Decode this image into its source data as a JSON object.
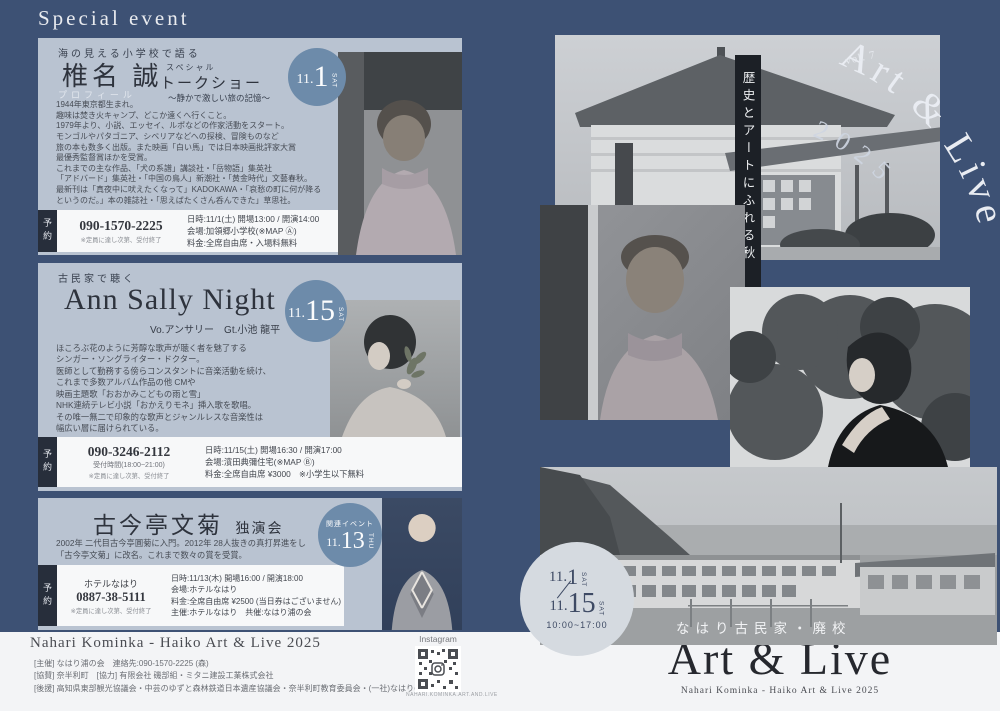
{
  "colors": {
    "background_navy": "#3d5174",
    "card_bg": "#b9c3d1",
    "date_circle_blue": "#6d8baa",
    "reserve_tab_dark": "#272e3b",
    "footer_bg": "#f3f4f6",
    "ribbon_black": "#1c2026"
  },
  "page": {
    "header_title": "Special event"
  },
  "events": [
    {
      "tagline": "海の見える小学校で語る",
      "title": "椎名 誠",
      "subtitle_small": "スペシャル",
      "subtitle": "トークショー",
      "subcaption": "〜静かで激しい旅の記憶〜",
      "badge": {
        "month": "11.",
        "day": "1",
        "dow": "SAT"
      },
      "profile_label": "プロフィール",
      "description": "1944年東京都生まれ。\n趣味は焚き火キャンプ、どこか遠くへ行くこと。\n1979年より、小説、エッセイ、ルポなどの作家活動をスタート。\nモンゴルやパタゴニア、シベリアなどへの探検、冒険ものなど\n旅の本も数多く出版。また映画「白い馬」では日本映画批評家大賞\n最優秀監督賞ほかを受賞。\nこれまでの主な作品、「犬の系譜」講談社・「岳物語」集英社\n「アドバード」集英社・「中国の鳥人」新潮社・「黄金時代」文藝春秋。\n最新刊は「真夜中に吠えたくなって」KADOKAWA・「哀愁の町に何が降る\nというのだ。」本の雑誌社・「思えばたくさん呑んできた」草思社。",
      "reserve_label": "予約",
      "phone": "090-1570-2225",
      "phone_note": "※定員に達し次第、受付終了",
      "details": "日時:11/1(土) 開場13:00 / 開演14:00\n会場:加領郷小学校(※MAP Ⓐ)\n料金:全席自由席・入場料無料"
    },
    {
      "tagline": "古民家で聴く",
      "title": "Ann Sally Night",
      "performers": "Vo.アンサリー　Gt.小池 龍平",
      "badge": {
        "month": "11.",
        "day": "15",
        "dow": "SAT"
      },
      "description": "ほころぶ花のように芳醇な歌声が聴く者を魅了する\nシンガー・ソングライター・ドクター。\n医師として勤務する傍らコンスタントに音楽活動を続け、\nこれまで多数アルバム作品の他 CMや\n映画主題歌「おおかみこどもの雨と雪」\nNHK連続テレビ小説「おかえりモネ」挿入歌を歌唱。\nその唯一無二で印象的な歌声とジャンルレスな音楽性は\n幅広い層に届けられている。",
      "reserve_label": "予約",
      "phone": "090-3246-2112",
      "phone_hours": "受付時間(18:00~21:00)",
      "phone_note": "※定員に達し次第、受付終了",
      "details": "日時:11/15(土) 開場16:30 / 開演17:00\n会場:濱田典彌住宅(※MAP Ⓑ)\n料金:全席自由席 ¥3000　※小学生以下無料"
    },
    {
      "title": "古今亭文菊",
      "title_suffix": "独演会",
      "badge": {
        "label": "関連イベント",
        "month": "11.",
        "day": "13",
        "dow": "THU"
      },
      "description": "2002年 二代目古今亭圓菊に入門。2012年 28人抜きの真打昇進をし\n「古今亭文菊」に改名。これまで数々の賞を受賞。",
      "reserve_label": "予約",
      "venue_name": "ホテルなはり",
      "phone": "0887-38-5111",
      "phone_note": "※定員に達し次第、受付終了",
      "details": "日時:11/13(木) 開場16:00 / 開演18:00\n会場:ホテルなはり\n料金:全席自由席 ¥2500 (当日券はございません)\n主催:ホテルなはり　共催:なはり浦の会"
    }
  ],
  "right_panel": {
    "vol_label": "vol. 7",
    "arc_title": "Art & Live",
    "arc_year": "2025",
    "ribbon_text": "歴史とアートにふれる秋",
    "venue_overlay": "なはり古民家・廃校",
    "schedule": {
      "start_month": "11.",
      "start_day": "1",
      "start_dow": "SAT",
      "end_month": "11.",
      "end_day": "15",
      "end_dow": "SAT",
      "hours": "10:00~17:00"
    }
  },
  "footer": {
    "heading": "Nahari Kominka - Haiko Art & Live 2025",
    "credits": "[主催] なはり浦の会　連絡先:090-1570-2225 (森)\n[協賛] 奈半利町　[協力] 有限会社 磯部組・ミタニ建設工業株式会社\n[後援] 高知県東部観光協議会・中芸のゆずと森林鉄道日本遺産協議会・奈半利町教育委員会・(一社)なはりの郷",
    "instagram_label": "Instagram",
    "qr_caption": "NAHARI.KOMINKA.ART.AND.LIVE",
    "logo_title": "Art & Live",
    "logo_year": "2025",
    "logo_caption": "Nahari Kominka - Haiko  Art & Live 2025"
  }
}
